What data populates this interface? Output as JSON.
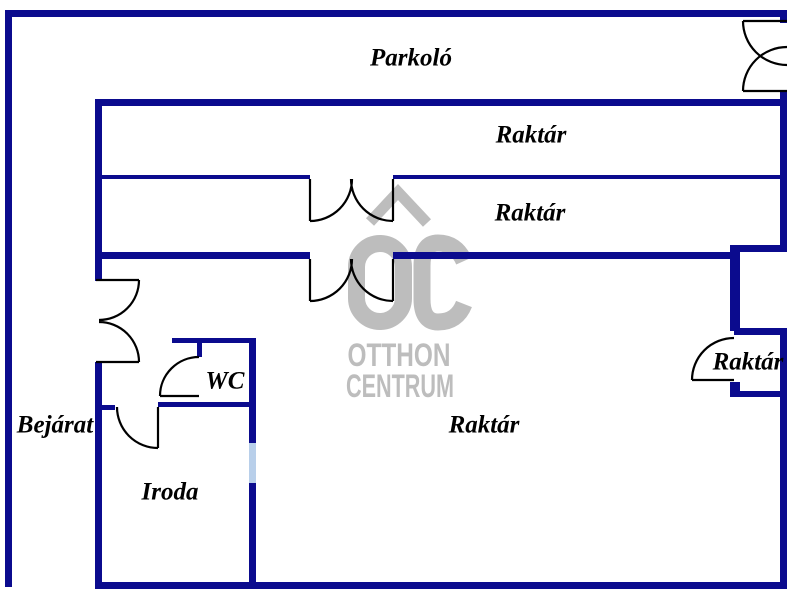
{
  "colors": {
    "wall": "#0b0b8e",
    "door": "#000000",
    "window": "#b8cfea",
    "watermark": "#bdbdbd",
    "label": "#000000",
    "background": "#ffffff"
  },
  "watermark": {
    "line1": "OTTHON",
    "line2": "CENTRUM"
  },
  "labels": [
    {
      "id": "parkolo",
      "text": "Parkoló",
      "x": 411,
      "y": 58
    },
    {
      "id": "raktar-band1",
      "text": "Raktár",
      "x": 531,
      "y": 135
    },
    {
      "id": "raktar-band2",
      "text": "Raktár",
      "x": 530,
      "y": 213
    },
    {
      "id": "raktar-small",
      "text": "Raktár",
      "x": 748,
      "y": 362
    },
    {
      "id": "raktar-main",
      "text": "Raktár",
      "x": 484,
      "y": 425
    },
    {
      "id": "wc",
      "text": "WC",
      "x": 225,
      "y": 381
    },
    {
      "id": "bejarat",
      "text": "Bejárat",
      "x": 55,
      "y": 425
    },
    {
      "id": "iroda",
      "text": "Iroda",
      "x": 170,
      "y": 492
    }
  ],
  "walls": [
    {
      "name": "outer-top-wall",
      "x": 5,
      "y": 10,
      "w": 782,
      "h": 7
    },
    {
      "name": "outer-left-wall",
      "x": 5,
      "y": 10,
      "w": 7,
      "h": 577
    },
    {
      "name": "outer-right-top-stub",
      "x": 780,
      "y": 10,
      "w": 7,
      "h": 13
    },
    {
      "name": "outer-right-mid-wall",
      "x": 780,
      "y": 91,
      "w": 7,
      "h": 161
    },
    {
      "name": "outer-right-low-wall",
      "x": 780,
      "y": 328,
      "w": 7,
      "h": 261
    },
    {
      "name": "bottom-wall",
      "x": 95,
      "y": 582,
      "w": 692,
      "h": 7
    },
    {
      "name": "inner-left-upper-wall",
      "x": 95,
      "y": 99,
      "w": 7,
      "h": 182
    },
    {
      "name": "inner-left-lower-wall",
      "x": 95,
      "y": 362,
      "w": 7,
      "h": 227
    },
    {
      "name": "band1-top-wall",
      "x": 95,
      "y": 99,
      "w": 692,
      "h": 7
    },
    {
      "name": "band-separator-left",
      "x": 95,
      "y": 175,
      "w": 215,
      "h": 4
    },
    {
      "name": "band-separator-right",
      "x": 393,
      "y": 175,
      "w": 394,
      "h": 4
    },
    {
      "name": "band-bottom-left",
      "x": 95,
      "y": 252,
      "w": 215,
      "h": 7
    },
    {
      "name": "band-bottom-right",
      "x": 393,
      "y": 252,
      "w": 340,
      "h": 7
    },
    {
      "name": "band-bottom-right-jog",
      "x": 730,
      "y": 245,
      "w": 57,
      "h": 7
    },
    {
      "name": "smallroom-left-wall",
      "x": 730,
      "y": 245,
      "w": 10,
      "h": 86
    },
    {
      "name": "smallroom-top-wall",
      "x": 734,
      "y": 328,
      "w": 53,
      "h": 7
    },
    {
      "name": "smallroom-door-stub",
      "x": 730,
      "y": 382,
      "w": 10,
      "h": 15
    },
    {
      "name": "smallroom-bottom-wall",
      "x": 730,
      "y": 391,
      "w": 57,
      "h": 6
    },
    {
      "name": "wc-top-wall",
      "x": 172,
      "y": 338,
      "w": 84,
      "h": 5
    },
    {
      "name": "wc-left-stub",
      "x": 197,
      "y": 343,
      "w": 5,
      "h": 14
    },
    {
      "name": "wc-bottom-wall",
      "x": 158,
      "y": 402,
      "w": 91,
      "h": 5
    },
    {
      "name": "iroda-door-stub",
      "x": 95,
      "y": 405,
      "w": 20,
      "h": 5
    },
    {
      "name": "divider-upper-wall",
      "x": 249,
      "y": 338,
      "w": 7,
      "h": 105
    },
    {
      "name": "iroda-window",
      "x": 249,
      "y": 443,
      "w": 7,
      "h": 40,
      "window": true
    },
    {
      "name": "divider-lower-wall",
      "x": 249,
      "y": 483,
      "w": 7,
      "h": 106
    }
  ],
  "doors": [
    {
      "name": "parkolo-entrance-door",
      "path": "M743 21 H787 M743 91 H787 M743 21 A44 44 0 0 0 787 65 M743 91 A44 44 0 0 1 787 47"
    },
    {
      "name": "bejarat-double-door",
      "path": "M96 280 H139 M96 362 H139 M139 280 A40 40 0 0 1 99 320 M139 362 A40 40 0 0 0 99 322"
    },
    {
      "name": "raktar-band-double-door",
      "path": "M310 179 V221 M393 179 V221 M310 221 A42 42 0 0 0 352 179 M393 221 A42 42 0 0 1 351 179"
    },
    {
      "name": "raktar-main-double-door",
      "path": "M310 259 V301 M393 259 V301 M310 301 A42 42 0 0 0 352 259 M393 301 A42 42 0 0 1 351 259"
    },
    {
      "name": "wc-door",
      "path": "M160 396 H199 M160 396 A39 39 0 0 1 199 357"
    },
    {
      "name": "iroda-door",
      "path": "M158 407 V448 M117 407 A41 41 0 0 0 158 448"
    },
    {
      "name": "raktar-small-door",
      "path": "M692 380 H734 M692 380 A42 42 0 0 1 734 338"
    }
  ]
}
